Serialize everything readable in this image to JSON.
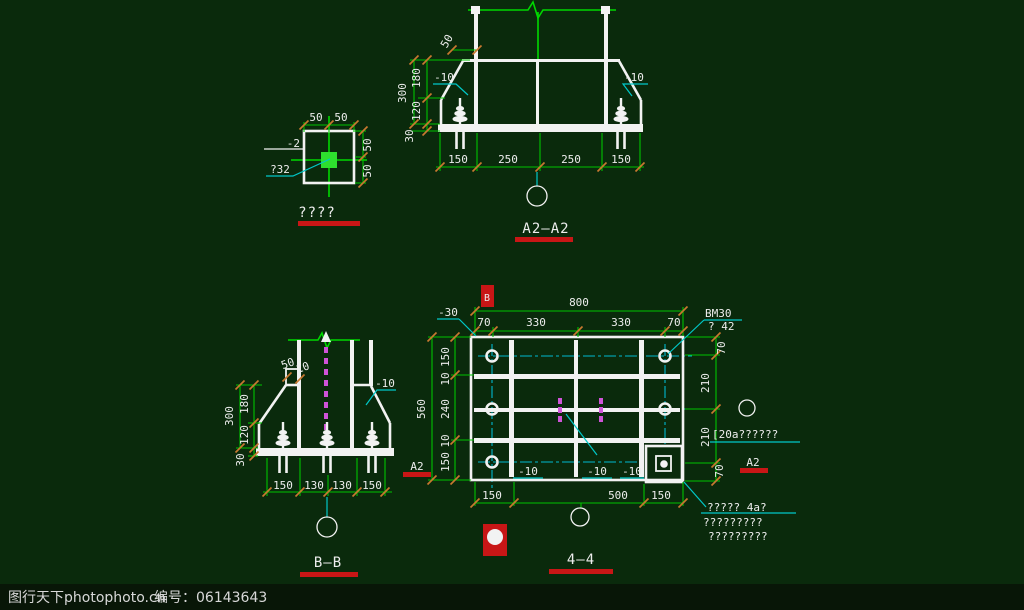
{
  "watermark": {
    "site": "图行天下photophoto.cn",
    "serial": "编号：06143643"
  },
  "detail_view": {
    "title": "????",
    "dim_top": [
      "50",
      "50"
    ],
    "dim_right": [
      "50",
      "50"
    ],
    "label_plate": "-2",
    "label_bolt": "?32"
  },
  "section_a2": {
    "title": "A2—A2",
    "dim_bottom": [
      "150",
      "250",
      "250",
      "150"
    ],
    "dim_left_overall": "300",
    "dim_left": [
      "180",
      "120",
      "30"
    ],
    "label_top": "50",
    "label_left": "-10",
    "label_right": "-10"
  },
  "section_b": {
    "title": "B—B",
    "dim_bottom": [
      "150",
      "130",
      "130",
      "150"
    ],
    "dim_left_overall": "300",
    "dim_left": [
      "180",
      "120",
      "30"
    ],
    "label_top_1": "50",
    "label_top_2": "10",
    "label_right": "-10"
  },
  "plan_view": {
    "title": "4—4",
    "dim_overall_top": "800",
    "dim_top": [
      "70",
      "330",
      "330",
      "70"
    ],
    "dim_left_overall": "560",
    "dim_left": [
      "150",
      "10",
      "240",
      "10",
      "150"
    ],
    "dim_right": [
      "70",
      "210",
      "210",
      "70"
    ],
    "dim_bottom": [
      "150",
      "500",
      "150"
    ],
    "label_bm": "BM30",
    "label_phi": "? 42",
    "label_neg30": "-30",
    "labels_neg10": [
      "-10",
      "-10",
      "-10"
    ],
    "label_channel": "[20a??????",
    "notes": [
      "?????  4a?",
      "?????????",
      "?????????"
    ],
    "marker_b": "B",
    "marker_a2_left": "A2",
    "marker_a2_right": "A2"
  }
}
